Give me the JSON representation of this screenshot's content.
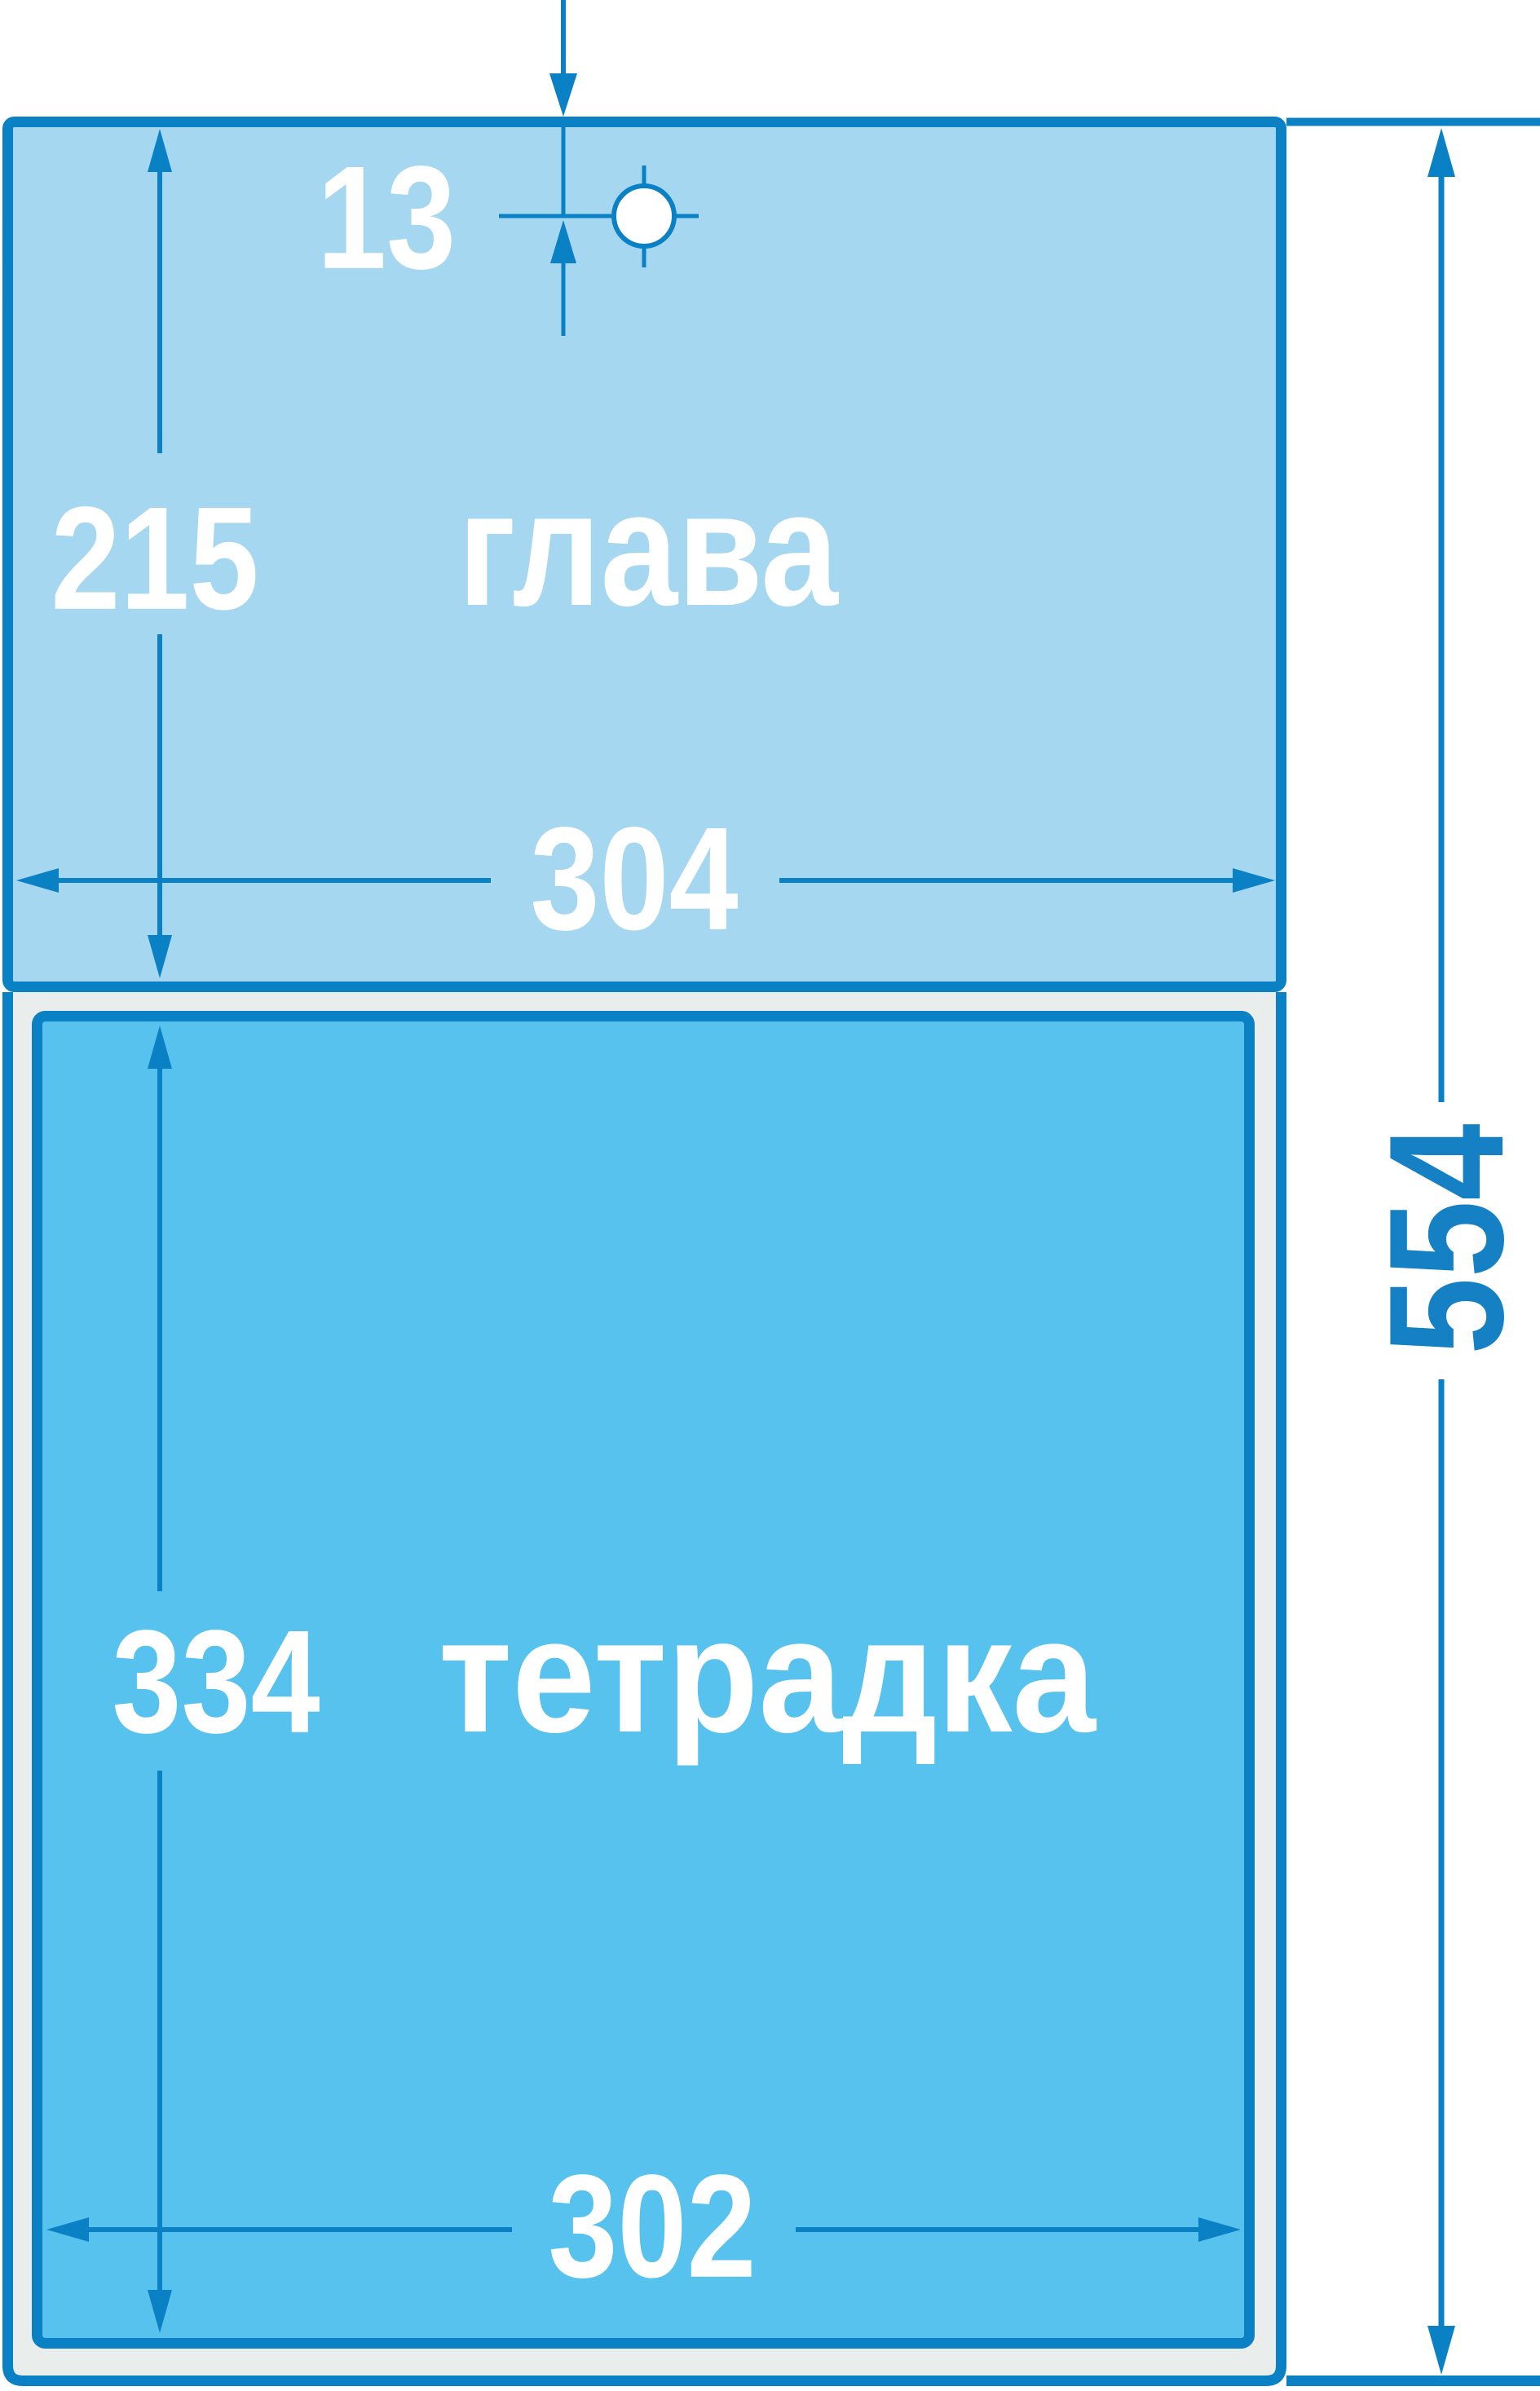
{
  "drawing": {
    "type": "technical-dimension-diagram",
    "parts": {
      "head": {
        "label": "глава"
      },
      "notebook": {
        "label": "тетрадка"
      }
    },
    "dimensions": {
      "hole_offset": "13",
      "head_height": "215",
      "head_width": "304",
      "notebook_height": "334",
      "notebook_width": "302",
      "total_height": "554"
    },
    "colors": {
      "line": "#0b81c5",
      "head_fill": "#a6d7f1",
      "notebook_fill": "#57c2ee",
      "outer_fill": "#e9edec",
      "hole_fill": "#ffffff",
      "label_white": "#ffffff",
      "label_blue": "#1580c4"
    }
  }
}
